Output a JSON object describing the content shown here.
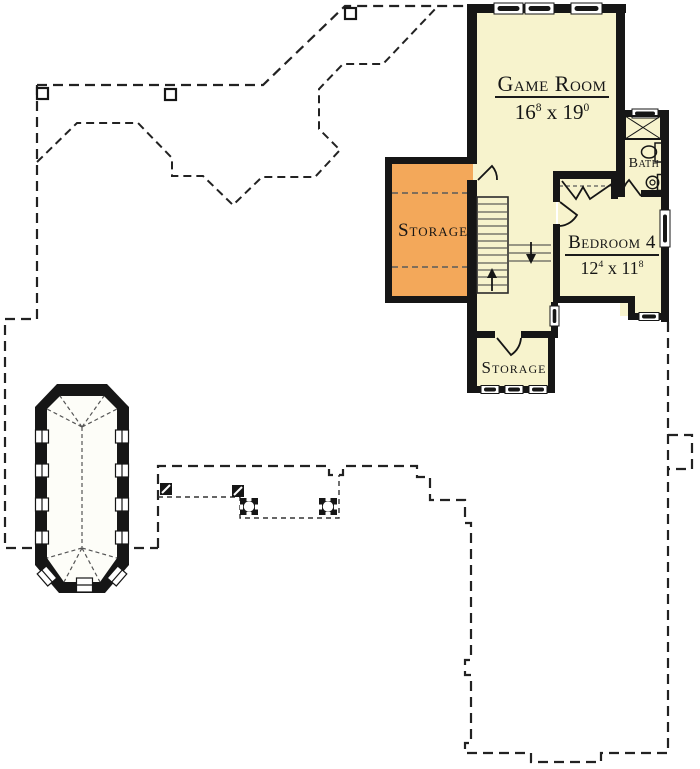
{
  "plan": {
    "rooms": {
      "game_room": {
        "name": "Game Room",
        "dims": {
          "num1": "16",
          "sup1": "8",
          "sep": " x ",
          "num2": "19",
          "sup2": "0"
        }
      },
      "bedroom_4": {
        "name": "Bedroom 4",
        "dims": {
          "num1": "12",
          "sup1": "4",
          "sep": " x ",
          "num2": "11",
          "sup2": "8"
        }
      },
      "bath": {
        "name": "Bath"
      },
      "storage_upper": {
        "name": "Storage"
      },
      "storage_lower": {
        "name": "Storage"
      }
    },
    "colors": {
      "room_fill": "#F7F3CD",
      "storage_fill": "#F3A85A",
      "wall": "#161616",
      "dashed_outline": "#222222",
      "background": "#FFFFFF"
    }
  }
}
